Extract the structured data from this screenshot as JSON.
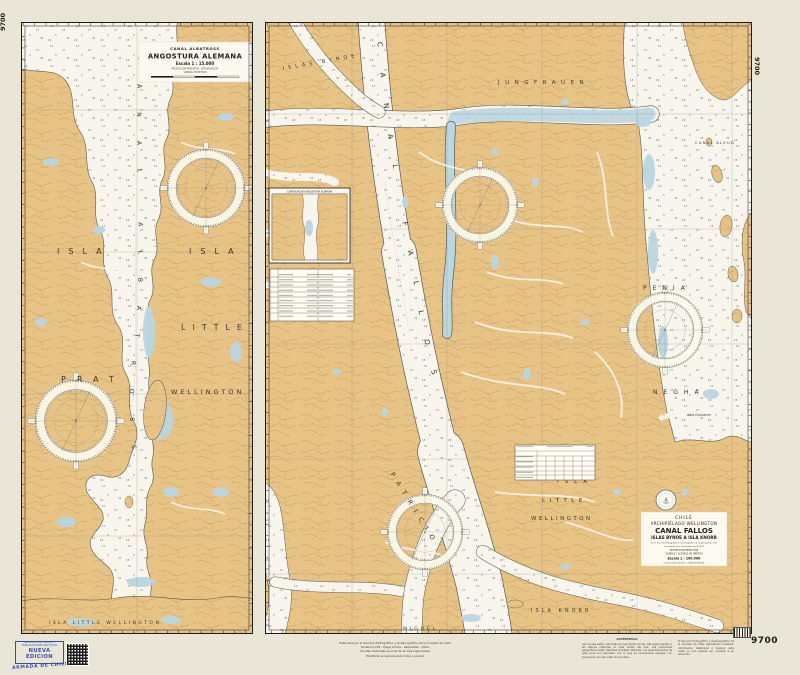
{
  "chart_number": "9700",
  "corners": {
    "tl": "9700",
    "tr": "9700",
    "br": "9700"
  },
  "left": {
    "title": {
      "region": "CANAL ALBATROSS",
      "name": "ANGOSTURA ALEMANA",
      "scale": "Escala 1 : 15.000",
      "note1": "PROYECCIÓN MERCATOR - DATUM WGS-84",
      "note2": "SONDAS EN METROS"
    },
    "labels": {
      "isla_w": "ISLA",
      "prat": "PRAT",
      "isla_e": "ISLA",
      "little": "LITTLE",
      "wellington": "WELLINGTON",
      "bottom": "ISLA LITTLE WELLINGTON",
      "channel": "CANAL ALBATROSS"
    }
  },
  "right": {
    "labels": {
      "bynoe": "ISLAS BYNOE",
      "jungfrauen": "JUNGFRAUEN",
      "channel": "CANAL FALLOS",
      "penia": "PENÍA",
      "negha": "NEGHA",
      "isla": "ISLA",
      "little": "LITTLE",
      "wellington": "WELLINGTON",
      "knorr": "ISLA KNORR",
      "patricio": "PATRICIO",
      "miguel": "MIGUEL",
      "canal_aleud": "CANAL ALEUD",
      "abra": "Abra Dunraven"
    },
    "title_block": {
      "country": "CHILE",
      "region": "ARCHIPIÉLAGO WELLINGTON",
      "name": "CANAL FALLOS",
      "subtitle": "ISLAS BYNOE A ISLA KNORR",
      "attribution": "Por el Servicio Hidrográfico y Oceanográfico de la Armada de Chile",
      "note1": "Levantamientos efectuados hasta 1997",
      "note2": "PROYECCIÓN MERCATOR",
      "note3": "SONDAS Y ALTURAS EN METROS",
      "scale": "Escala 1 : 100.000",
      "note4": "Latitud media 48°40' S  -  DATUM WGS-84"
    },
    "inset_title": "CONTINUACIÓN ANGOSTURA ALEMANA"
  },
  "margin": {
    "stamp1": "DEPÓSITO DE CARTAS Y",
    "stamp2": "PUBLICACIONES NÁUTICAS",
    "new_edition": "NUEVA EDICION",
    "armada": "ARMADA DE CHILE",
    "pub1": "Publicada por el Servicio Hidrográfico y Oceanográfico de la Armada de Chile",
    "pub2": "Errázuriz 254 - Playa Ancha - Valparaíso - Chile",
    "pub3": "Sondas reducidas al nivel de la más baja marea",
    "pub4": "Prohibida la reproducción total o parcial",
    "notesA_title": "ADVERTENCIA",
    "notesA": "Las sondas están reducidas al nivel medio de las más bajas mareas y las alturas referidas al nivel medio del mar. Las posiciones geográficas están referidas al Dátum WGS-84. Los levantamientos de esta zona son parciales, por lo que se recomienda navegar con precaución por las rutas reconocidas.",
    "notesB": "El Servicio Hidrográfico y Oceanográfico de la Armada de Chile agradecerá cualquier información destinada a mejorar esta carta, la que deberá ser enviada a su Dirección."
  }
}
